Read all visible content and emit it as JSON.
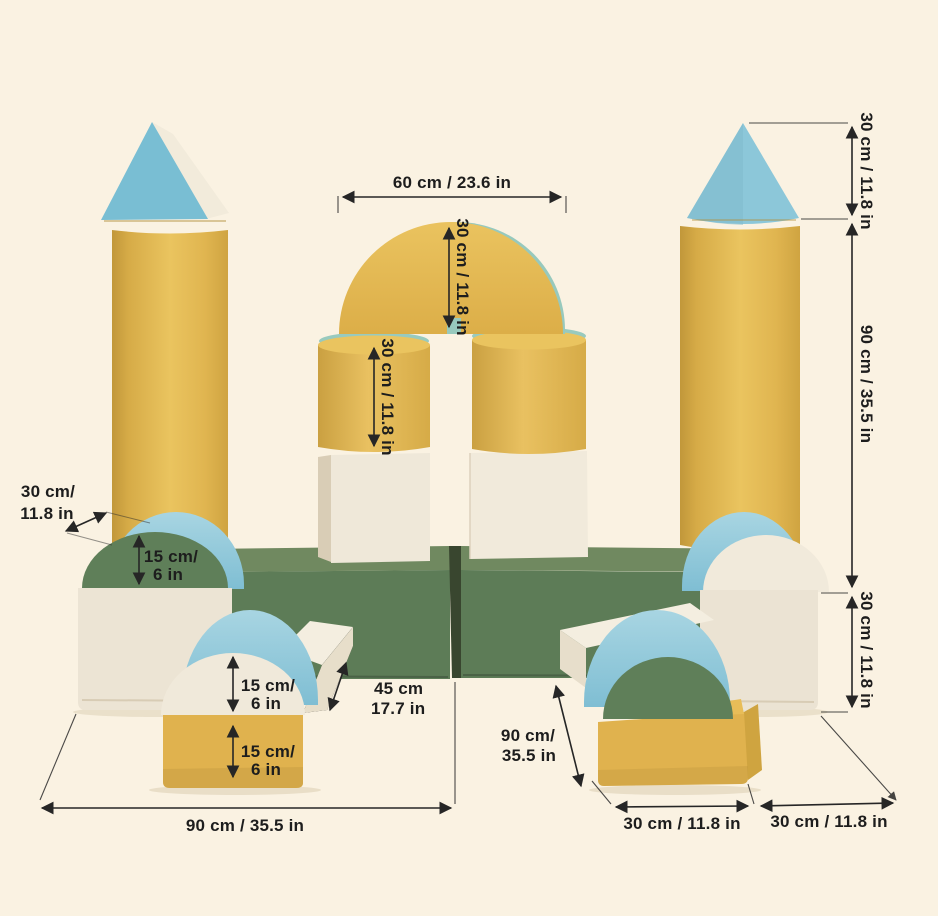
{
  "palette": {
    "background": "#faf2e2",
    "yellow": "#e3b552",
    "blue": "#8cc7d9",
    "cream": "#ece4d4",
    "green": "#5d7c57",
    "line": "#262626",
    "text": "#1d1d1d"
  },
  "dimensions": {
    "arch_width": "60 cm / 23.6 in",
    "arch_height": "30 cm / 11.8 in",
    "mid_cylinder_height": "30 cm / 11.8 in",
    "cone_height": "30 cm / 11.8 in",
    "tower_height": "90 cm / 35.5 in",
    "right_cube_height": "30 cm / 11.8 in",
    "block_depth": {
      "l1": "30 cm/",
      "l2": "11.8 in"
    },
    "back_half_cylinder_height": {
      "l1": "15 cm/",
      "l2": "6 in"
    },
    "front_half_cylinder_height": {
      "l1": "15 cm/",
      "l2": "6 in"
    },
    "front_block_height": {
      "l1": "15 cm/",
      "l2": "6 in"
    },
    "step_depth": {
      "l1": "45 cm",
      "l2": "17.7 in"
    },
    "long_block_length": {
      "l1": "90 cm/",
      "l2": "35.5 in"
    },
    "base_width": "90 cm / 35.5 in",
    "bottom_width_left": "30 cm / 11.8 in",
    "bottom_width_right": "30 cm / 11.8 in"
  }
}
